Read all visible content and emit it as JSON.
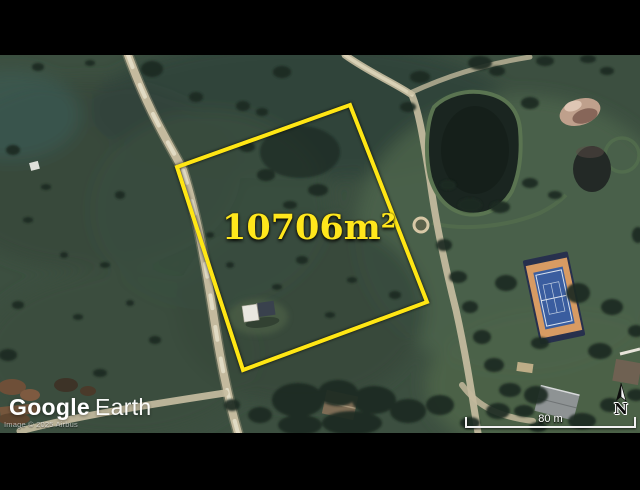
{
  "map": {
    "type": "google-earth-satellite-view",
    "parcel": {
      "area_label": "10706m²",
      "outline_color": "#ffe614"
    },
    "branding": {
      "logo_google": "Google",
      "logo_earth": "Earth"
    },
    "attribution": "Image © 2025 Airbus",
    "scale_bar": {
      "label": "80 m"
    },
    "compass": {
      "label": "N"
    }
  }
}
